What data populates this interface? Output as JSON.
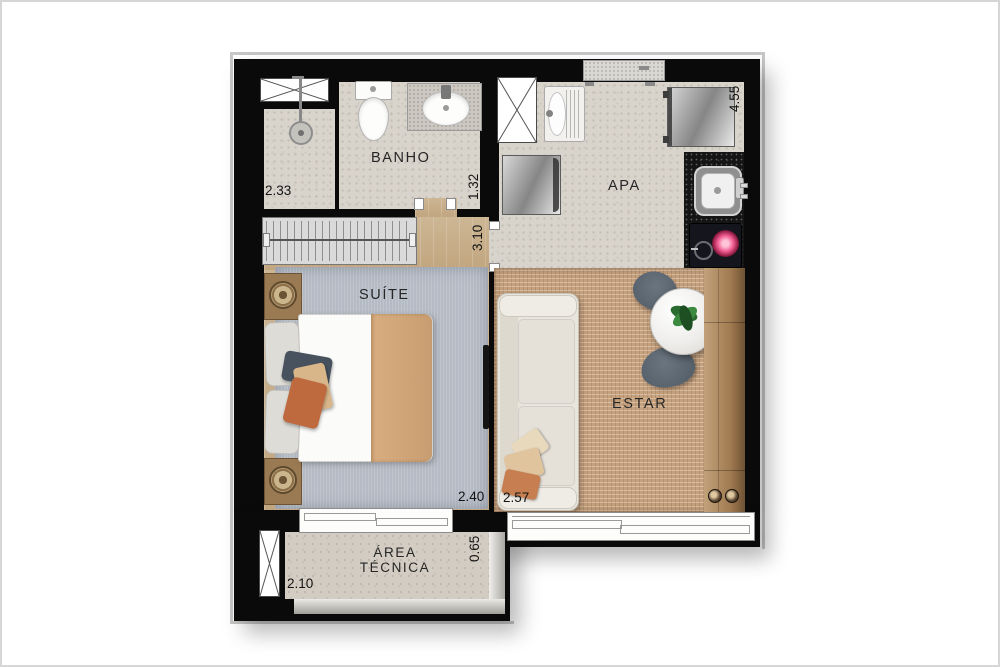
{
  "type": "apartment-floor-plan",
  "rooms": {
    "banho": {
      "label": "BANHO",
      "dim_width": "2.33",
      "dim_depth": "1.32"
    },
    "apa": {
      "label": "APA",
      "dim_height": "4.55"
    },
    "suite": {
      "label": "SUÍTE",
      "dim_hall_width": "3.10",
      "dim_width": "2.40"
    },
    "estar": {
      "label": "ESTAR",
      "dim_width": "2.57"
    },
    "area_tecnica": {
      "label_line1": "ÁREA",
      "label_line2": "TÉCNICA",
      "dim_width": "2.10",
      "dim_depth": "0.65"
    }
  },
  "fixtures": [
    "shower",
    "toilet",
    "bathroom-sink",
    "ventilation-shaft",
    "entry-door",
    "laundry-tank",
    "washing-machine",
    "refrigerator",
    "kitchen-counter",
    "kitchen-sink",
    "induction-cooktop",
    "wardrobe",
    "double-bed",
    "nightstand",
    "tv",
    "sofa",
    "round-dining-table",
    "dining-chair",
    "plant",
    "sideboard",
    "window"
  ],
  "colors": {
    "wall": "#0a0a0a",
    "tile_floor": "#d8d3cb",
    "wood_floor": "#c9b28f",
    "suite_rug": "#b5bbc5",
    "estar_rug": "#c6a17d",
    "black_granite": "#151515",
    "sideboard_wood": "#a07a50",
    "appliance_steel": "#9a9a9a",
    "burner_accent": "#e0457b"
  }
}
